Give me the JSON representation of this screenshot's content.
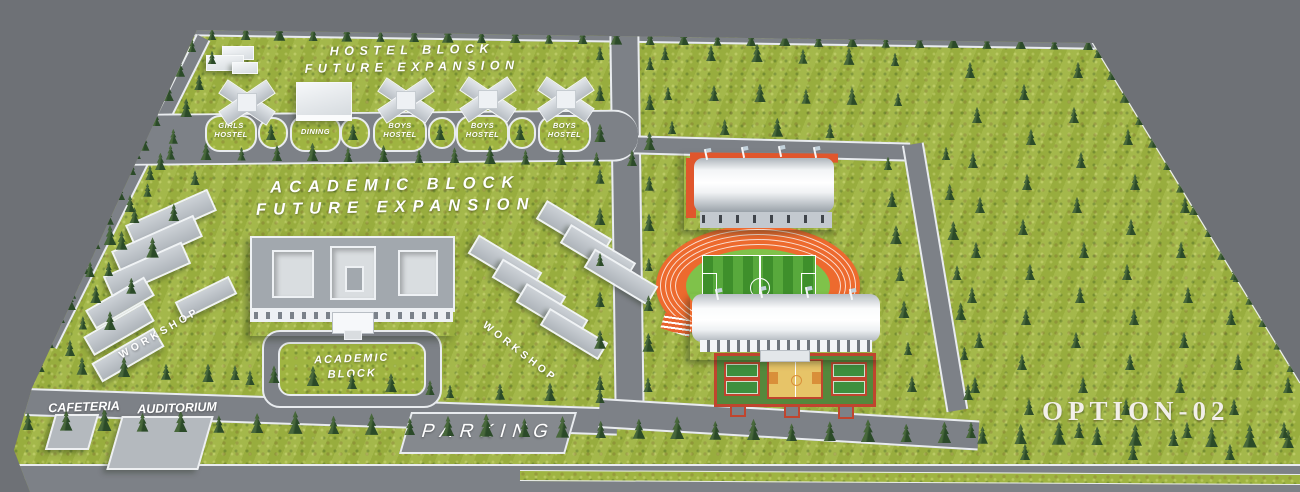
{
  "plan": {
    "option_label": "OPTION-02"
  },
  "colors": {
    "background": "#6e7176",
    "grass": "#9fb441",
    "road": "#7d8187",
    "curb": "#e9ecef",
    "tree": "#2b4a28",
    "building_white": "#eef1f4",
    "roof_gray": "#a2a8ae",
    "track_orange": "#ed6a2e",
    "pitch_green": "#4f9a30",
    "court_red": "#c0452e",
    "court_green": "#3e8f3e",
    "court_yellow": "#e7c468",
    "label_white": "#ffffff"
  },
  "hostel_zone": {
    "heading": {
      "line1": "HOSTEL BLOCK",
      "line2": "FUTURE EXPANSION"
    },
    "islands": [
      {
        "l1": "GIRLS",
        "l2": "HOSTEL"
      },
      {
        "l1": "DINING",
        "l2": ""
      },
      {
        "l1": "BOYS",
        "l2": "HOSTEL"
      },
      {
        "l1": "BOYS",
        "l2": "HOSTEL"
      },
      {
        "l1": "BOYS",
        "l2": "HOSTEL"
      }
    ]
  },
  "academic_zone": {
    "heading": {
      "line1": "ACADEMIC BLOCK",
      "line2": "FUTURE EXPANSION"
    },
    "island": {
      "l1": "ACADEMIC",
      "l2": "BLOCK"
    },
    "workshop_left": "WORKSHOP",
    "workshop_right": "WORKSHOP"
  },
  "south_zone": {
    "cafeteria": "CAFETERIA",
    "auditorium": "AUDITORIUM",
    "parking": "PARKING"
  }
}
